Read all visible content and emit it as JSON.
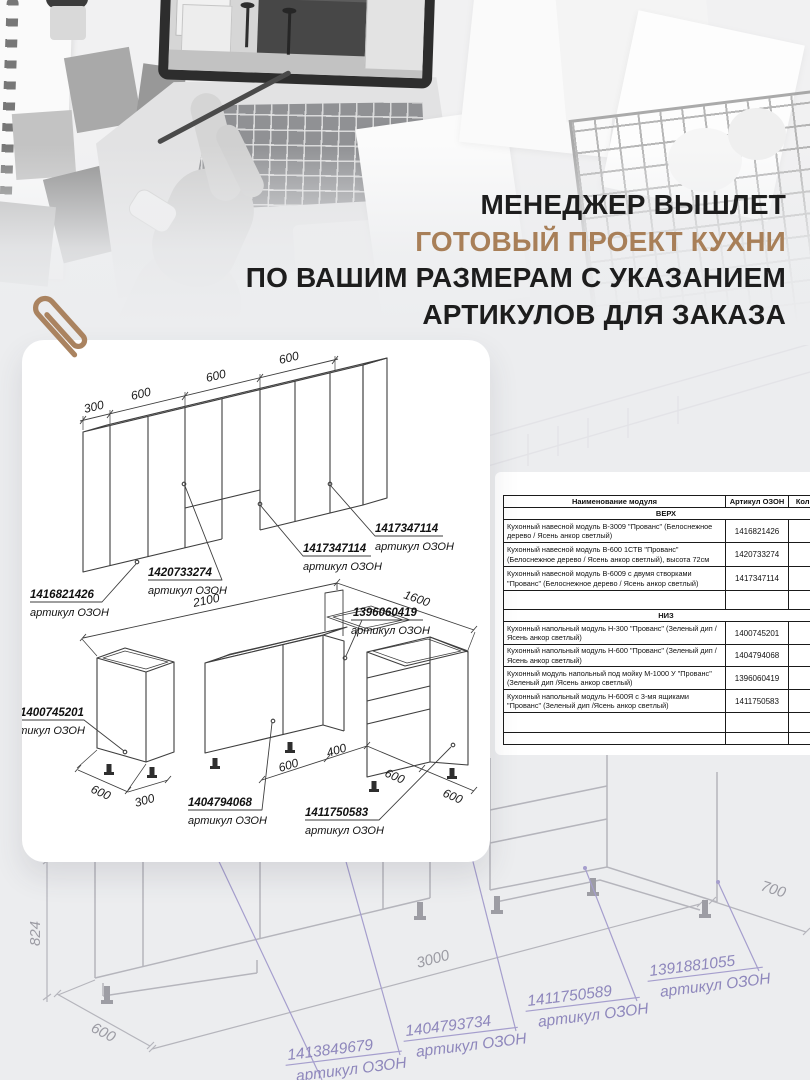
{
  "colors": {
    "accent_brown": "#a87f58",
    "label_purple": "#8e87bc",
    "ink": "#1d1d1d",
    "background": "#ecedef"
  },
  "headline": {
    "line1": "МЕНЕДЖЕР ВЫШЛЕТ",
    "line2": "ГОТОВЫЙ ПРОЕКТ КУХНИ",
    "line3": "ПО ВАШИМ РАЗМЕРАМ С УКАЗАНИЕМ",
    "line4": "АРТИКУЛОВ ДЛЯ ЗАКАЗА"
  },
  "card": {
    "upper": {
      "dims": [
        "300",
        "600",
        "600",
        "600"
      ],
      "labels": [
        {
          "article": "1416821426",
          "caption": "артикул ОЗОН"
        },
        {
          "article": "1420733274",
          "caption": "артикул ОЗОН"
        },
        {
          "article": "1417347114",
          "caption": "артикул ОЗОН"
        },
        {
          "article": "1417347114",
          "caption": "артикул ОЗОН"
        }
      ]
    },
    "lower": {
      "dim_2100": "2100",
      "dim_1600": "1600",
      "standalone_dims": [
        "600",
        "300"
      ],
      "bottom_dims": [
        "600",
        "400",
        "600",
        "600"
      ],
      "labels": [
        {
          "article": "1400745201",
          "caption": "артикул ОЗОН"
        },
        {
          "article": "1396060419",
          "caption": "артикул ОЗОН"
        },
        {
          "article": "1404794068",
          "caption": "артикул ОЗОН"
        },
        {
          "article": "1411750583",
          "caption": "артикул ОЗОН"
        }
      ]
    }
  },
  "table": {
    "headers": [
      "Наименование модуля",
      "Артикул ОЗОН",
      "Кол-во"
    ],
    "section_top": "ВЕРХ",
    "rows_top": [
      {
        "name": "Кухонный навесной модуль В-3009 \"Прованс\" (Белоснежное дерево / Ясень анкор светлый)",
        "article": "1416821426"
      },
      {
        "name": "Кухонный навесной модуль В-600 1СТВ \"Прованс\" (Белоснежное дерево / Ясень анкор светлый), высота 72см",
        "article": "1420733274"
      },
      {
        "name": "Кухонный навесной модуль В-6009 с двумя створками \"Прованс\" (Белоснежное дерево / Ясень анкор светлый)",
        "article": "1417347114"
      }
    ],
    "section_bottom": "НИЗ",
    "rows_bottom": [
      {
        "name": "Кухонный напольный модуль Н-300 \"Прованс\" (Зеленый дип /Ясень анкор светлый)",
        "article": "1400745201"
      },
      {
        "name": "Кухонный напольный модуль Н-600 \"Прованс\" (Зеленый дип /Ясень анкор светлый)",
        "article": "1404794068"
      },
      {
        "name": "Кухонный модуль напольный под мойку М-1000 У \"Прованс\" (Зеленый дип /Ясень анкор светлый)",
        "article": "1396060419"
      },
      {
        "name": "Кухонный напольный модуль Н-600Я с 3-мя ящиками \"Прованс\" (Зеленый дип /Ясень анкор светлый)",
        "article": "1411750583"
      }
    ]
  },
  "sketch": {
    "dims": {
      "height": "824",
      "depth": "600",
      "length": "3000",
      "right": "700"
    },
    "labels": [
      {
        "article": "1413849679",
        "caption": "артикул ОЗОН"
      },
      {
        "article": "1404793734",
        "caption": "артикул ОЗОН"
      },
      {
        "article": "1411750589",
        "caption": "артикул ОЗОН"
      },
      {
        "article": "1391881055",
        "caption": "артикул ОЗОН"
      }
    ]
  }
}
